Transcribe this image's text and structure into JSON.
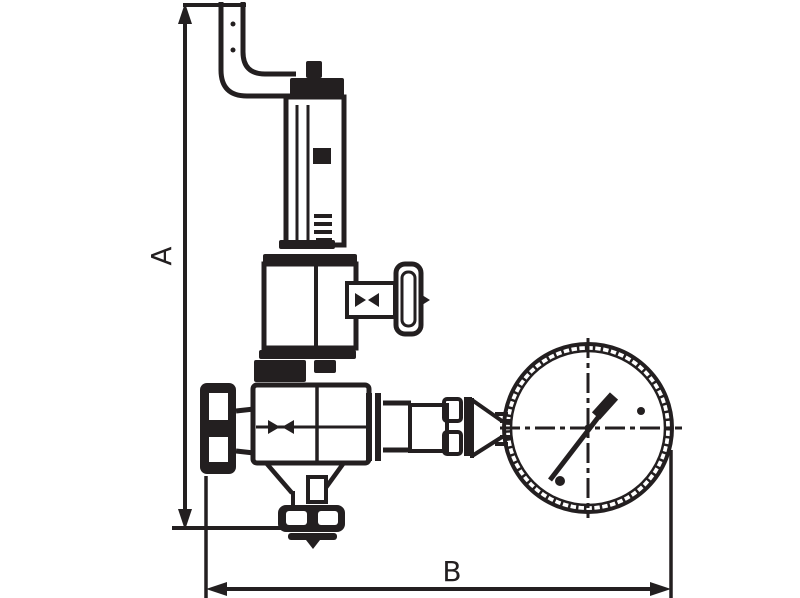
{
  "diagram": {
    "type": "technical-drawing",
    "subject": "pressure-reducing-valve-with-gauge",
    "labels": {
      "dim_a": "A",
      "dim_b": "B"
    },
    "colors": {
      "ink": "#231f20",
      "paper": "#ffffff"
    },
    "components": [
      "vent-pipe",
      "adjusting-cap",
      "spring-housing",
      "bonnet",
      "test-valve-handwheel",
      "inlet-handwheel",
      "valve-body",
      "bottom-outlet-flange",
      "union-nut",
      "pressure-gauge",
      "gauge-needle",
      "dimension-a",
      "dimension-b"
    ]
  }
}
